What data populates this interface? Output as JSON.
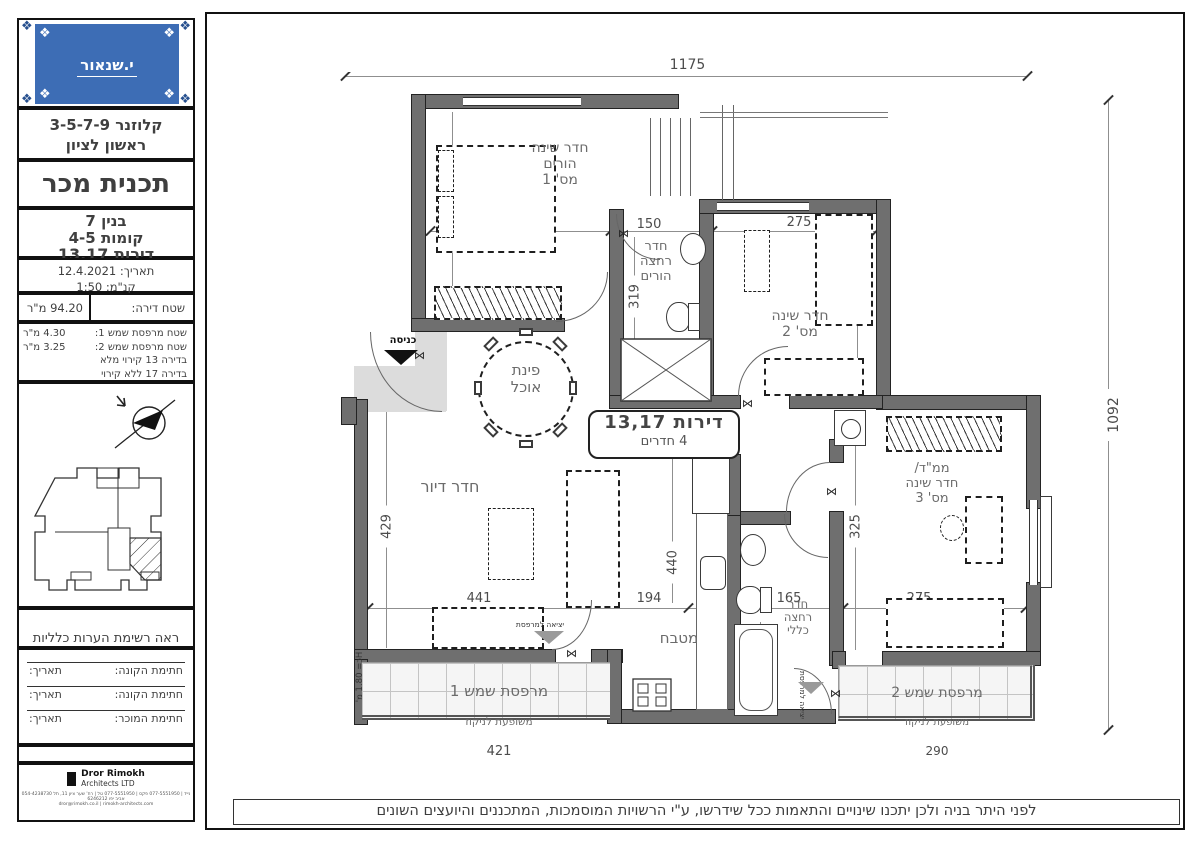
{
  "sidebar": {
    "logo_brand": "י.שנאור",
    "project_line1": "קלוזנר 3-5-7-9",
    "project_line2": "ראשון לציון",
    "plan_title": "תכנית מכר",
    "building_line1": "בנין 7",
    "building_line2": "קומות 4-5",
    "building_line3": "דירות 13,17",
    "date_line": "תאריך: 12.4.2021",
    "scale_line": "קנ\"מ: 1:50",
    "area_label": "שטח דירה:",
    "area_value": "94.20 מ\"ר",
    "balcony_row1_label": "שטח מרפסת שמש 1:",
    "balcony_row1_value": "4.30 מ\"ר",
    "balcony_row2_label": "שטח מרפסת שמש 2:",
    "balcony_row2_value": "3.25 מ\"ר",
    "balcony_note1": "בדירה 13 קירוי מלא",
    "balcony_note2": "בדירה 17 ללא קירוי",
    "notes": "ראה רשימת הערות כלליות\nומקרא בתחילת חוברת זו",
    "sig1_label": "חתימת הקונה:",
    "sig1_date": "תאריך:",
    "sig2_label": "חתימת הקונה:",
    "sig2_date": "תאריך:",
    "sig3_label": "חתימת המוכר:",
    "sig3_date": "תאריך:",
    "architect_name": "Dror Rimokh",
    "architect_sub": "Architects LTD",
    "architect_contact": "054-4238730 נייד | 077-5551950 פקס | 077-5551950 טל | רח' שער ציון 11, תל אביב יפו 6246212",
    "architect_web": "dror@rimokh.co.il | rimokh-architects.com"
  },
  "plan": {
    "dim_top": "1175",
    "dim_right": "1092",
    "bed1_label": "חדר שינה\nהורים\nמס' 1",
    "bed1_w": "316",
    "bed1_h": "353",
    "bath1_label": "חדר\nרחצה\nהורים",
    "bath1_w": "150",
    "bath1_h": "319",
    "bed2_label": "חדר שינה\nמס' 2",
    "bed2_w": "275",
    "bed2_h": "319",
    "dining_label": "פינת\nאוכל",
    "unit_line1": "דירות 13,17",
    "unit_line2": "4 חדרים",
    "living_label": "חדר דיור",
    "living_h": "429",
    "living_w": "441",
    "kitchen_label": "מטבח",
    "kitchen_w": "194",
    "kitchen_h": "440",
    "bath2_label": "חדר\nרחצה\nכללי",
    "bath2_w": "165",
    "bath2_h": "325",
    "mamad_label": "ממ\"ד/\nחדר שינה\nמס' 3",
    "mamad_w": "275",
    "mamad_h": "325",
    "balcony1_name": "מרפסת שמש 1",
    "balcony1_sub": "משופעת לניקוז",
    "balcony1_w": "421",
    "balcony1_h": "87",
    "balcony2_name": "מרפסת שמש 2",
    "balcony2_sub": "משופעת לניקוז",
    "balcony2_w": "290",
    "balcony2_h": "87",
    "entrance_label": "כניסה",
    "exit1_label": "יציאה למרפסת",
    "exit2_label": "יציאה למרפסת",
    "railing_note": "Hכ= 1.80 מ'",
    "disclaimer": "לפני היתר בניה ולכן יתכנו שינויים והתאמות ככל שידרשו, ע\"י הרשויות המוסמכות, המתכננים והיועצים השונים"
  }
}
